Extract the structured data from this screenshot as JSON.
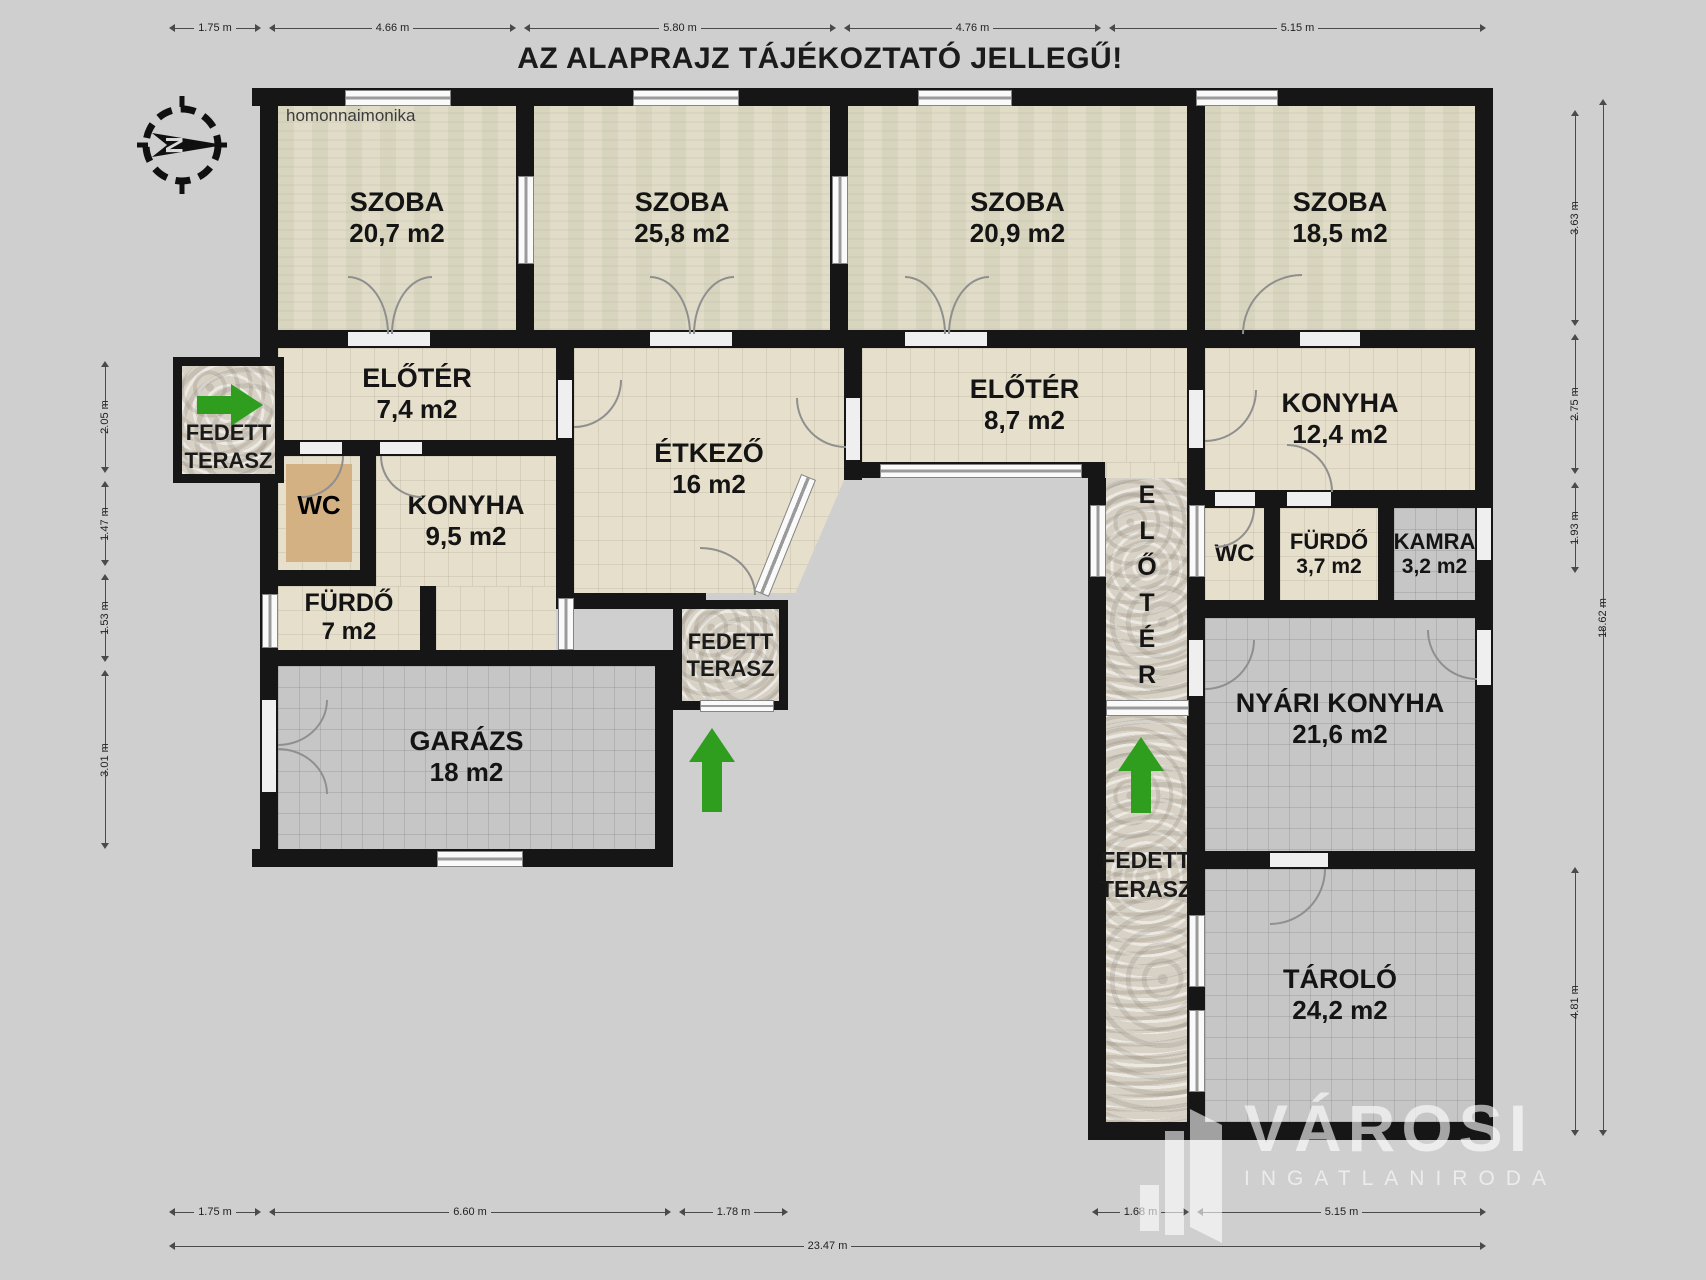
{
  "title": "AZ ALAPRAJZ TÁJÉKOZTATÓ JELLEGŰ!",
  "watermark": "homonnaimonika",
  "compass": {
    "letter": "N"
  },
  "rooms": {
    "szoba1": {
      "name": "SZOBA",
      "area": "20,7 m2"
    },
    "szoba2": {
      "name": "SZOBA",
      "area": "25,8 m2"
    },
    "szoba3": {
      "name": "SZOBA",
      "area": "20,9 m2"
    },
    "szoba4": {
      "name": "SZOBA",
      "area": "18,5 m2"
    },
    "eloter1": {
      "name": "ELŐTÉR",
      "area": "7,4 m2"
    },
    "etkezo": {
      "name": "ÉTKEZŐ",
      "area": "16 m2"
    },
    "eloter2": {
      "name": "ELŐTÉR",
      "area": "8,7 m2"
    },
    "konyha2": {
      "name": "KONYHA",
      "area": "12,4 m2"
    },
    "wc1": {
      "name": "WC",
      "area": ""
    },
    "konyha1": {
      "name": "KONYHA",
      "area": "9,5 m2"
    },
    "furdo1": {
      "name": "FÜRDŐ",
      "area": "7 m2"
    },
    "wc2": {
      "name": "WC",
      "area": ""
    },
    "furdo2": {
      "name": "FÜRDŐ",
      "area": "3,7 m2"
    },
    "kamra": {
      "name": "KAMRA",
      "area": "3,2 m2"
    },
    "garazs": {
      "name": "GARÁZS",
      "area": "18 m2"
    },
    "nyari": {
      "name": "NYÁRI KONYHA",
      "area": "21,6 m2"
    },
    "tarolo": {
      "name": "TÁROLÓ",
      "area": "24,2 m2"
    },
    "eloter_corridor": {
      "name": "ELŐTÉR"
    }
  },
  "terasz": {
    "left": {
      "line1": "FEDETT",
      "line2": "TERASZ"
    },
    "center": {
      "line1": "FEDETT",
      "line2": "TERASZ"
    },
    "right": {
      "line1": "FEDETT",
      "line2": "TERASZ"
    }
  },
  "dims": {
    "top": [
      "1.75 m",
      "4.66 m",
      "5.80 m",
      "4.76 m",
      "5.15 m"
    ],
    "bottom": [
      "1.75 m",
      "6.60 m",
      "1.78 m",
      "1.68 m",
      "5.15 m"
    ],
    "bottom_total": "23.47 m",
    "left": [
      "2.05 m",
      "1.47 m",
      "1.53 m",
      "3.01 m"
    ],
    "right": [
      "3.63 m",
      "2.75 m",
      "1.93 m",
      "4.81 m"
    ],
    "right_total": "18.62 m"
  },
  "logo": {
    "brand": "VÁROSI",
    "sub": "INGATLANIRODA"
  },
  "colors": {
    "background": "#cfcfcf",
    "wall": "#161616",
    "room_cream": "#e6dfcc",
    "room_textured": "#dcd8c2",
    "room_gray": "#c6c6c6",
    "stone": "#d8d2c6",
    "wc_fixture_tan": "#d4b183",
    "arrow_green": "#2f9e1f",
    "logo_white": "rgba(255,255,255,0.6)"
  }
}
